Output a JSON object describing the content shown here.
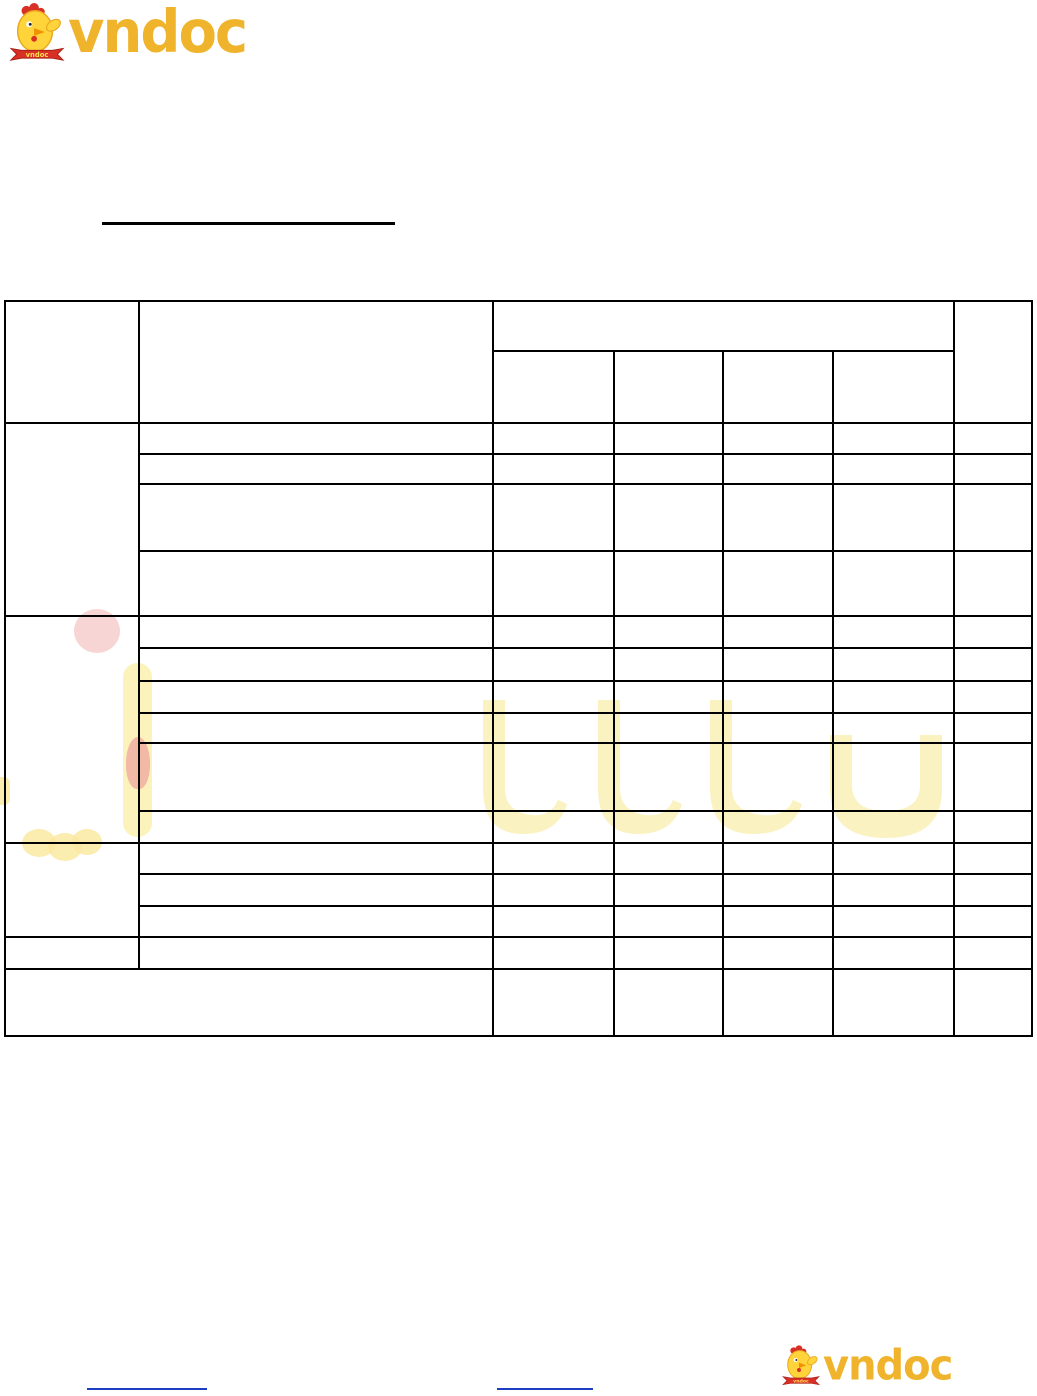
{
  "page": {
    "background": "#ffffff"
  },
  "logo_top": {
    "text": "vndoc",
    "ribbon_text": "vndoc"
  },
  "logo_bottom": {
    "text": "vndoc",
    "ribbon_text": "vndoc"
  },
  "heading": {
    "text": ""
  },
  "table": {
    "header": {
      "col_a_label": "",
      "col_b_label": "",
      "group_label": "",
      "sub_labels": [
        "",
        "",
        "",
        ""
      ],
      "col_last_label": ""
    },
    "groups": [
      {
        "group_label": "",
        "rows": [
          [
            "",
            "",
            "",
            "",
            "",
            ""
          ],
          [
            "",
            "",
            "",
            "",
            "",
            ""
          ],
          [
            "",
            "",
            "",
            "",
            "",
            ""
          ],
          [
            "",
            "",
            "",
            "",
            "",
            ""
          ]
        ]
      },
      {
        "group_label": "",
        "rows": [
          [
            "",
            "",
            "",
            "",
            "",
            ""
          ],
          [
            "",
            "",
            "",
            "",
            "",
            ""
          ],
          [
            "",
            "",
            "",
            "",
            "",
            ""
          ],
          [
            "",
            "",
            "",
            "",
            "",
            ""
          ],
          [
            "",
            "",
            "",
            "",
            "",
            ""
          ],
          [
            "",
            "",
            "",
            "",
            "",
            ""
          ]
        ]
      },
      {
        "group_label": "",
        "rows": [
          [
            "",
            "",
            "",
            "",
            "",
            ""
          ],
          [
            "",
            "",
            "",
            "",
            "",
            ""
          ],
          [
            "",
            "",
            "",
            "",
            "",
            ""
          ]
        ]
      }
    ],
    "single_row": [
      "",
      "",
      "",
      "",
      "",
      "",
      ""
    ],
    "total_row": [
      "",
      "",
      "",
      "",
      "",
      ""
    ]
  },
  "footer": {
    "link1_text": "",
    "link2_text": ""
  },
  "colors": {
    "logo_gold": "#f0b32c",
    "chicken_yellow": "#ffd43a",
    "accent_red": "#d93025",
    "link_blue": "#1d3ec0",
    "table_border": "#000000",
    "watermark_yellow": "#f5e683",
    "watermark_pink": "#f6c7c7"
  }
}
